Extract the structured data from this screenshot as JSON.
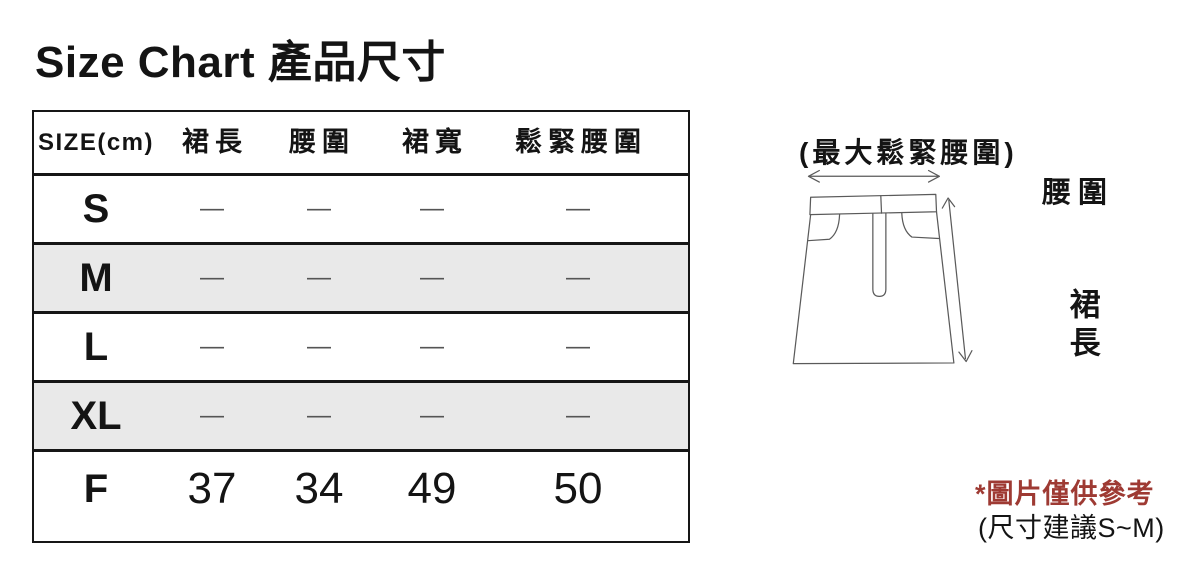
{
  "title": "Size Chart 產品尺寸",
  "table": {
    "size_header": "SIZE(cm)",
    "columns": [
      "裙長",
      "腰圍",
      "裙寬",
      "鬆緊腰圍"
    ],
    "rows": [
      {
        "size": "S",
        "values": [
          "—",
          "—",
          "—",
          "—"
        ]
      },
      {
        "size": "M",
        "values": [
          "—",
          "—",
          "—",
          "—"
        ]
      },
      {
        "size": "L",
        "values": [
          "—",
          "—",
          "—",
          "—"
        ]
      },
      {
        "size": "XL",
        "values": [
          "—",
          "—",
          "—",
          "—"
        ]
      },
      {
        "size": "F",
        "values": [
          "37",
          "34",
          "49",
          "50"
        ]
      }
    ]
  },
  "diagram": {
    "max_elastic_waist_label": "(最大鬆緊腰圍)",
    "waist_label": "腰圍",
    "skirt_length_label": "裙長",
    "reference_note": "*圖片僅供參考",
    "size_suggestion_note": "(尺寸建議S~M)"
  },
  "colors": {
    "note_red": "#9e3a33",
    "row_shade": "#e9e9e9",
    "line_gray": "#5a5a5a",
    "border_black": "#161616"
  }
}
